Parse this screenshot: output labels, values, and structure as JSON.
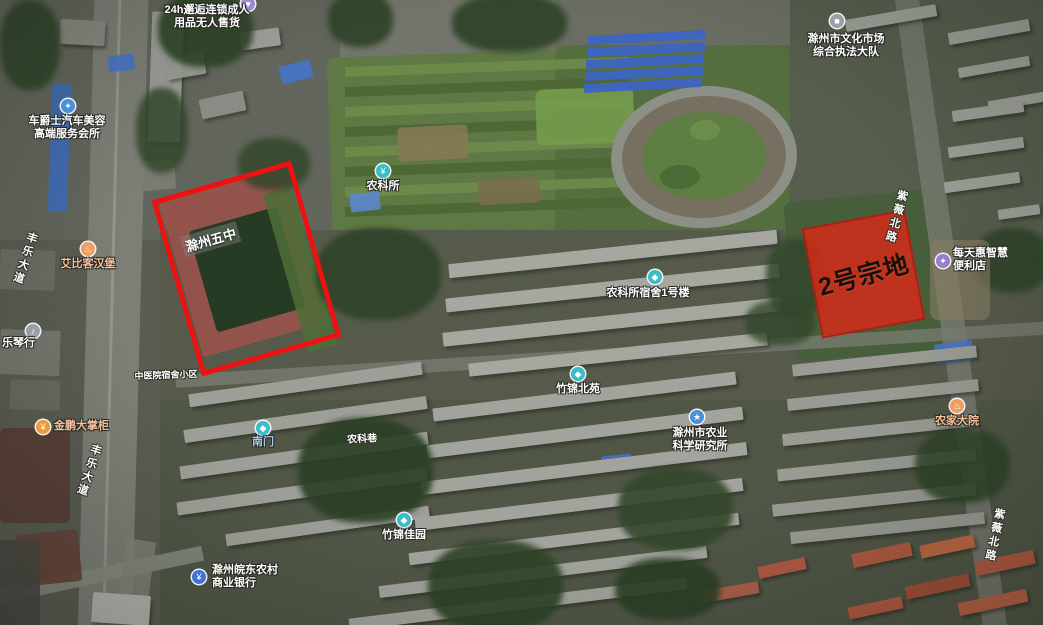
{
  "map": {
    "type": "satellite",
    "overlays": {
      "school_parcel": {
        "label": "滁州五中",
        "outline_color": "#ee1111"
      },
      "parcel2": {
        "label": "2号宗地",
        "fill_color": "#dd2817",
        "text_color": "#181008"
      }
    },
    "pois": [
      {
        "name": "adult-goods-store",
        "lines": [
          "24h邂逅连锁成人",
          "用品无人售货"
        ],
        "icon": {
          "color": "#9d8ad0",
          "glyph": "♥"
        },
        "icon_xy": [
          248,
          4
        ],
        "text_xy": [
          207,
          4
        ],
        "align": "center",
        "text_color": "#ffffff"
      },
      {
        "name": "car-beauty-club",
        "lines": [
          "车爵士汽车美容",
          "高端服务会所"
        ],
        "icon": {
          "color": "#4a90d9",
          "glyph": "✦"
        },
        "icon_xy": [
          68,
          106
        ],
        "text_xy": [
          67,
          115
        ],
        "align": "center",
        "text_color": "#ffffff"
      },
      {
        "name": "culture-market-enforcement",
        "lines": [
          "滁州市文化市场",
          "综合执法大队"
        ],
        "icon": {
          "color": "#9aa0a8",
          "glyph": "■"
        },
        "icon_xy": [
          837,
          21
        ],
        "text_xy": [
          846,
          33
        ],
        "align": "center",
        "text_color": "#ffffff"
      },
      {
        "name": "agri-science-station",
        "lines": [
          "农科所"
        ],
        "icon": {
          "color": "#3bbcc9",
          "glyph": "¥"
        },
        "icon_xy": [
          383,
          171
        ],
        "text_xy": [
          383,
          180
        ],
        "align": "center",
        "text_color": "#ffffff"
      },
      {
        "name": "aibike-burger",
        "lines": [
          "艾比客汉堡"
        ],
        "icon": {
          "color": "#ef9d63",
          "glyph": "♨"
        },
        "icon_xy": [
          88,
          249
        ],
        "text_xy": [
          88,
          258
        ],
        "align": "center",
        "text_color": "#f6c09a"
      },
      {
        "name": "nongkesuo-dorm-building-1",
        "lines": [
          "农科所宿舍1号楼"
        ],
        "icon": {
          "color": "#3bbcc9",
          "glyph": "◆"
        },
        "icon_xy": [
          655,
          277
        ],
        "text_xy": [
          648,
          287
        ],
        "align": "center",
        "text_color": "#ffffff"
      },
      {
        "name": "zhujin-north-court",
        "lines": [
          "竹锦北苑"
        ],
        "icon": {
          "color": "#3bbcc9",
          "glyph": "◆"
        },
        "icon_xy": [
          578,
          374
        ],
        "text_xy": [
          578,
          383
        ],
        "align": "center",
        "text_color": "#ffffff"
      },
      {
        "name": "agri-research-institute",
        "lines": [
          "滁州市农业",
          "科学研究所"
        ],
        "icon": {
          "color": "#4a90d9",
          "glyph": "★"
        },
        "icon_xy": [
          697,
          417
        ],
        "text_xy": [
          700,
          427
        ],
        "align": "center",
        "text_color": "#ffffff"
      },
      {
        "name": "smart-convenience-store",
        "lines": [
          "每天惠智慧",
          "便利店"
        ],
        "icon": {
          "color": "#9b7cd4",
          "glyph": "✦"
        },
        "icon_xy": [
          943,
          261
        ],
        "text_xy": [
          953,
          247
        ],
        "align": "left",
        "text_color": "#ffffff"
      },
      {
        "name": "farmhouse-restaurant",
        "lines": [
          "农家大院"
        ],
        "icon": {
          "color": "#ef9d63",
          "glyph": "♨"
        },
        "icon_xy": [
          957,
          406
        ],
        "text_xy": [
          957,
          415
        ],
        "align": "center",
        "text_color": "#f6c09a"
      },
      {
        "name": "zhujin-jiayuan",
        "lines": [
          "竹锦佳园"
        ],
        "icon": {
          "color": "#3bbcc9",
          "glyph": "◆"
        },
        "icon_xy": [
          404,
          520
        ],
        "text_xy": [
          404,
          529
        ],
        "align": "center",
        "text_color": "#ffffff"
      },
      {
        "name": "wandong-rural-bank",
        "lines": [
          "滁州皖东农村",
          "商业银行"
        ],
        "icon": {
          "color": "#3f74d6",
          "glyph": "¥"
        },
        "icon_xy": [
          199,
          577
        ],
        "text_xy": [
          212,
          564
        ],
        "align": "left",
        "text_color": "#ffffff"
      },
      {
        "name": "jinpeng-store",
        "lines": [
          "金鹏大掌柜"
        ],
        "icon": {
          "color": "#f09a3e",
          "glyph": "¥"
        },
        "icon_xy": [
          43,
          427
        ],
        "text_xy": [
          54,
          420
        ],
        "align": "left",
        "text_color": "#f6c09a"
      },
      {
        "name": "music-instrument-store",
        "lines": [
          "乐琴行"
        ],
        "icon": {
          "color": "#9aa0a8",
          "glyph": "♪"
        },
        "icon_xy": [
          33,
          331
        ],
        "text_xy": [
          2,
          337
        ],
        "align": "left",
        "text_color": "#ffffff"
      },
      {
        "name": "south-gate",
        "lines": [
          "南门"
        ],
        "icon": {
          "color": "#3bbcc9",
          "glyph": "◆"
        },
        "icon_xy": [
          263,
          428
        ],
        "text_xy": [
          263,
          436
        ],
        "align": "center",
        "text_color": "#a8c8f0"
      }
    ],
    "road_labels": [
      {
        "name": "fengle-avenue-north",
        "text": "丰乐大道",
        "xy": [
          33,
          232
        ],
        "vertical": true,
        "rotate": 18
      },
      {
        "name": "fengle-avenue-south",
        "text": "丰乐大道",
        "xy": [
          97,
          444
        ],
        "vertical": true,
        "rotate": 18
      },
      {
        "name": "ziwei-north-road-upper",
        "text": "紫薇北路",
        "xy": [
          903,
          190
        ],
        "vertical": true,
        "rotate": 15
      },
      {
        "name": "ziwei-north-road-lower",
        "text": "紫薇北路",
        "xy": [
          1000,
          508
        ],
        "vertical": true,
        "rotate": 12
      },
      {
        "name": "nongke-lane",
        "text": "农科巷",
        "xy": [
          362,
          430
        ],
        "vertical": false,
        "rotate": -3,
        "size": 10
      },
      {
        "name": "hospital-dorm-area",
        "text": "中医院宿舍小区",
        "xy": [
          166,
          368
        ],
        "vertical": false,
        "rotate": -2,
        "size": 9
      }
    ]
  }
}
